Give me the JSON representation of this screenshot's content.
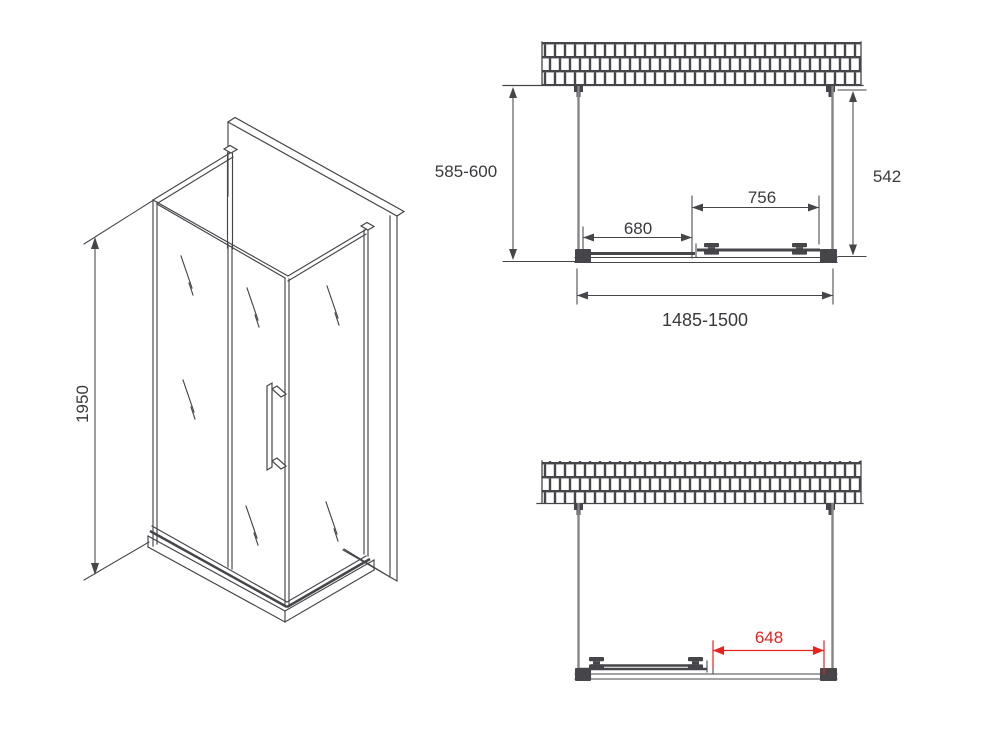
{
  "colors": {
    "background": "#ffffff",
    "line": "#45454a",
    "glass_line": "#85858a",
    "text": "#3a3a3e",
    "highlight": "#e8231e"
  },
  "drawing": {
    "kind": "shower-enclosure-technical-drawing",
    "isometric_view": {
      "height_label": "1950"
    },
    "plan_view_closed": {
      "side_depth_label": "585-600",
      "inner_depth_label": "542",
      "door_span_label": "756",
      "fixed_span_label": "680",
      "total_width_label": "1485-1500"
    },
    "plan_view_open": {
      "entry_width_label": "648"
    }
  }
}
